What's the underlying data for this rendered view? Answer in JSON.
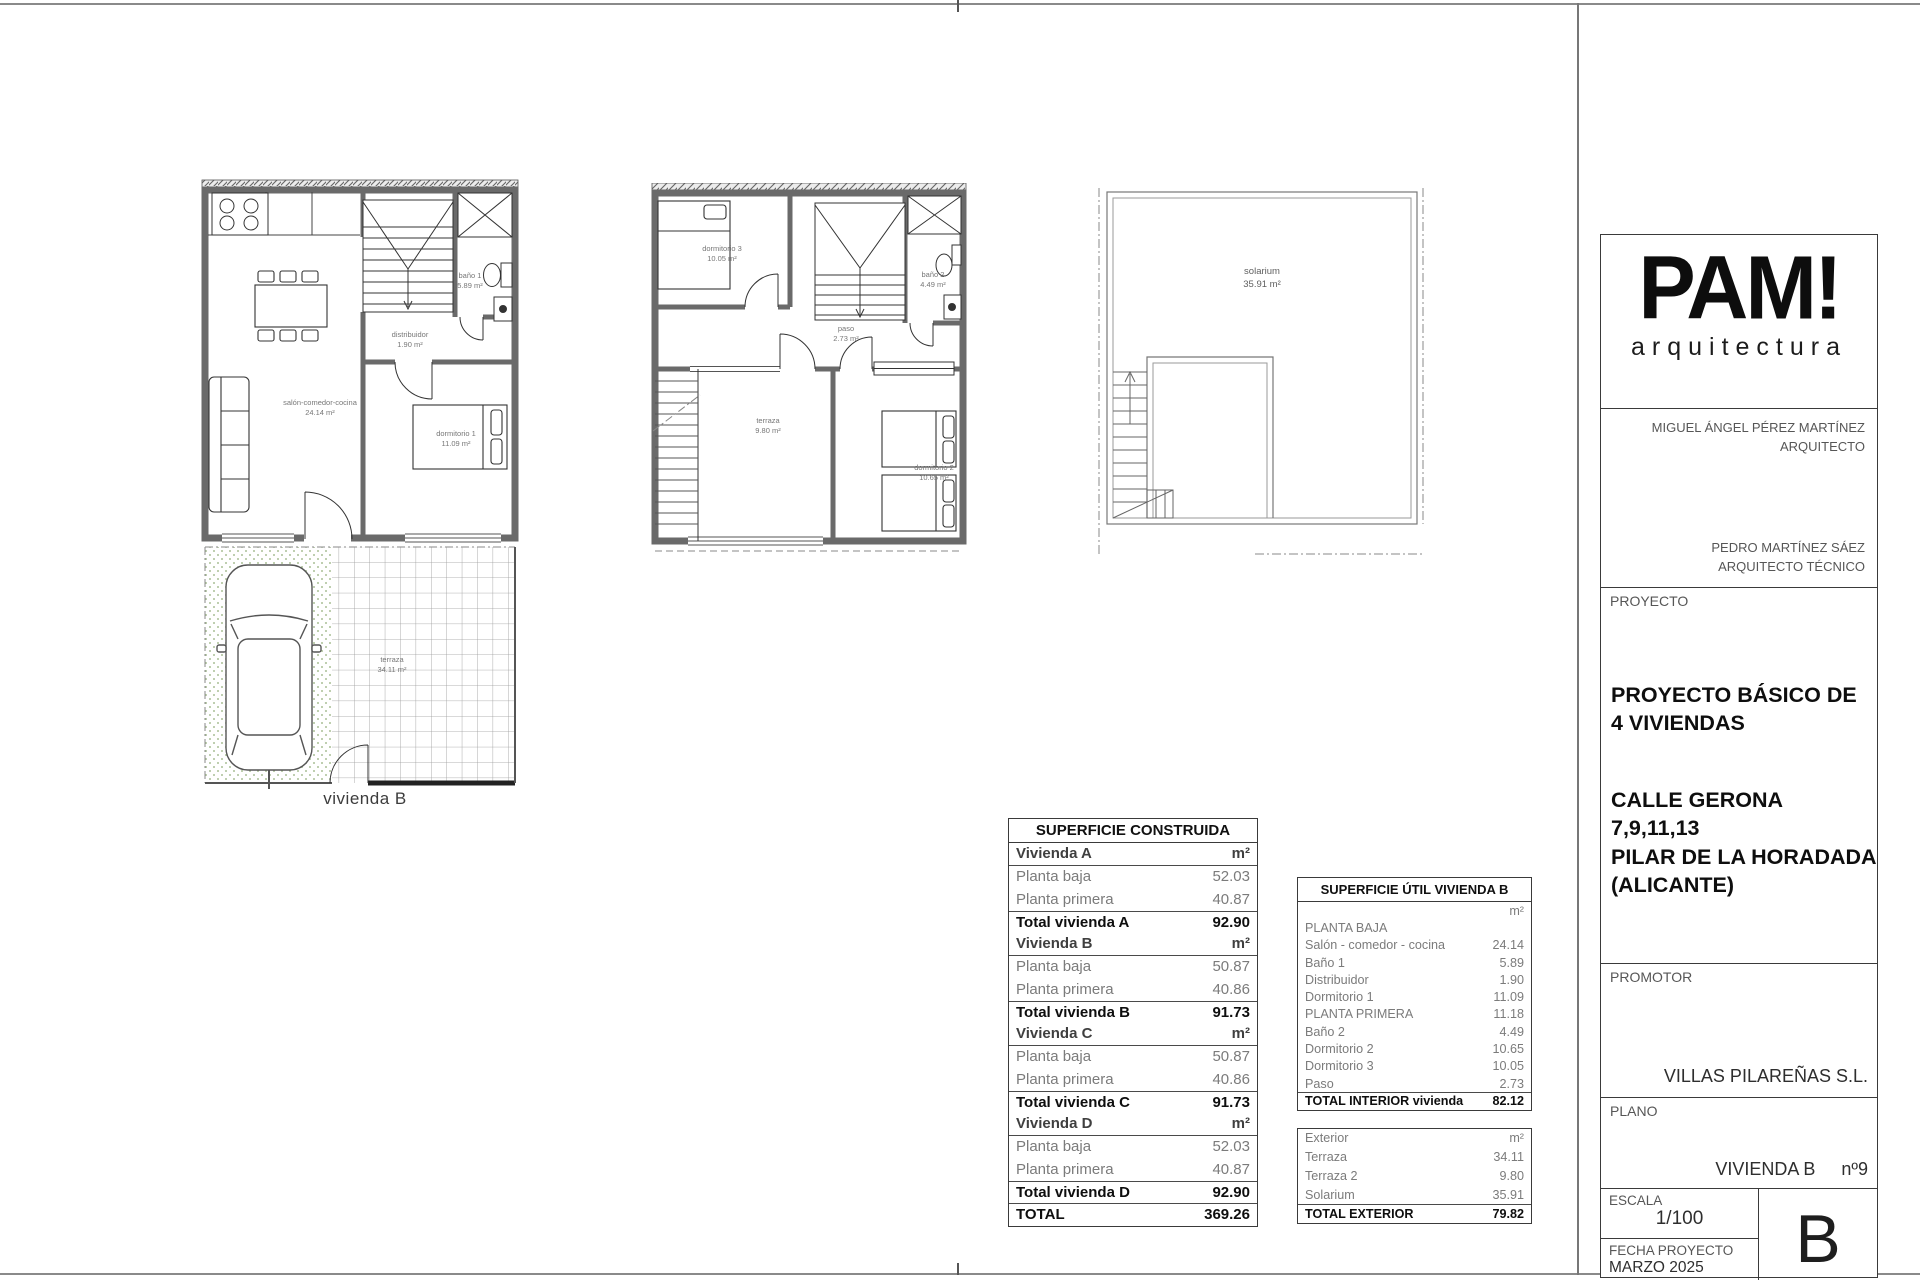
{
  "plans": {
    "ground_floor": {
      "caption": "vivienda B",
      "salon_name": "salón-comedor-cocina",
      "salon_area": "24.14 m²",
      "distribuidor_name": "distribuidor",
      "distribuidor_area": "1.90 m²",
      "bano1_name": "baño 1",
      "bano1_area": "5.89 m²",
      "dormitorio1_name": "dormitorio 1",
      "dormitorio1_area": "11.09 m²",
      "terraza_name": "terraza",
      "terraza_area": "34.11 m²"
    },
    "first_floor": {
      "dormitorio3_name": "dormitorio 3",
      "dormitorio3_area": "10.05 m²",
      "bano2_name": "baño 2",
      "bano2_area": "4.49 m²",
      "paso_name": "paso",
      "paso_area": "2.73 m²",
      "terraza_name": "terraza",
      "terraza_area": "9.80 m²",
      "dormitorio2_name": "dormitorio 2",
      "dormitorio2_area": "10.65 m²"
    },
    "solarium_floor": {
      "solarium_name": "solarium",
      "solarium_area": "35.91 m²"
    }
  },
  "tables": {
    "construida": {
      "title": "SUPERFICIE CONSTRUIDA",
      "rows": [
        {
          "label": "Vivienda A",
          "value": "m²",
          "style": "section"
        },
        {
          "label": "Planta baja",
          "value": "52.03",
          "style": "item"
        },
        {
          "label": "Planta primera",
          "value": "40.87",
          "style": "item"
        },
        {
          "label": "Total vivienda A",
          "value": "92.90",
          "style": "total"
        },
        {
          "label": "Vivienda B",
          "value": "m²",
          "style": "section"
        },
        {
          "label": "Planta baja",
          "value": "50.87",
          "style": "item"
        },
        {
          "label": "Planta primera",
          "value": "40.86",
          "style": "item"
        },
        {
          "label": "Total vivienda B",
          "value": "91.73",
          "style": "total"
        },
        {
          "label": "Vivienda C",
          "value": "m²",
          "style": "section"
        },
        {
          "label": "Planta baja",
          "value": "50.87",
          "style": "item"
        },
        {
          "label": "Planta primera",
          "value": "40.86",
          "style": "item"
        },
        {
          "label": "Total vivienda C",
          "value": "91.73",
          "style": "total"
        },
        {
          "label": "Vivienda D",
          "value": "m²",
          "style": "section"
        },
        {
          "label": "Planta baja",
          "value": "52.03",
          "style": "item"
        },
        {
          "label": "Planta primera",
          "value": "40.87",
          "style": "item"
        },
        {
          "label": "Total vivienda D",
          "value": "92.90",
          "style": "total"
        },
        {
          "label": "TOTAL",
          "value": "369.26",
          "style": "grand"
        }
      ]
    },
    "util": {
      "title": "SUPERFICIE ÚTIL VIVIENDA B",
      "interior_rows": [
        {
          "label": "",
          "value": "m²",
          "style": "unit"
        },
        {
          "label": "PLANTA BAJA",
          "value": "",
          "style": "floor"
        },
        {
          "label": "Salón - comedor - cocina",
          "value": "24.14",
          "style": "item"
        },
        {
          "label": "Baño 1",
          "value": "5.89",
          "style": "item"
        },
        {
          "label": "Distribuidor",
          "value": "1.90",
          "style": "item"
        },
        {
          "label": "Dormitorio 1",
          "value": "11.09",
          "style": "item"
        },
        {
          "label": "PLANTA PRIMERA",
          "value": "11.18",
          "style": "floor"
        },
        {
          "label": "Baño 2",
          "value": "4.49",
          "style": "item"
        },
        {
          "label": "Dormitorio 2",
          "value": "10.65",
          "style": "item"
        },
        {
          "label": "Dormitorio 3",
          "value": "10.05",
          "style": "item"
        },
        {
          "label": "Paso",
          "value": "2.73",
          "style": "item"
        },
        {
          "label": "TOTAL INTERIOR vivienda",
          "value": "82.12",
          "style": "total"
        }
      ],
      "exterior_rows": [
        {
          "label": "Exterior",
          "value": "m²",
          "style": "unit"
        },
        {
          "label": "Terraza",
          "value": "34.11",
          "style": "item"
        },
        {
          "label": "Terraza 2",
          "value": "9.80",
          "style": "item"
        },
        {
          "label": "Solarium",
          "value": "35.91",
          "style": "item"
        },
        {
          "label": "TOTAL EXTERIOR",
          "value": "79.82",
          "style": "total"
        }
      ]
    }
  },
  "title_block": {
    "brand": "PAM!",
    "brand_sub": "arquitectura",
    "architect_name": "MIGUEL ÁNGEL PÉREZ MARTÍNEZ",
    "architect_role": "ARQUITECTO",
    "tech_name": "PEDRO MARTÍNEZ SÁEZ",
    "tech_role": "ARQUITECTO TÉCNICO",
    "proyecto_label": "PROYECTO",
    "proyecto_title_line1": "PROYECTO BÁSICO DE",
    "proyecto_title_line2": "4 VIVIENDAS",
    "address_line1": "CALLE GERONA",
    "address_line2": "7,9,11,13",
    "address_line3": "PILAR DE LA HORADADA",
    "address_line4": "(ALICANTE)",
    "promotor_label": "PROMOTOR",
    "promotor_value": "VILLAS PILAREÑAS S.L.",
    "plano_label": "PLANO",
    "plano_value": "VIVIENDA B",
    "plano_number": "nº9",
    "escala_label": "ESCALA",
    "escala_value": "1/100",
    "fecha_label": "FECHA PROYECTO",
    "fecha_value": "MARZO 2025",
    "sheet_letter": "B"
  }
}
